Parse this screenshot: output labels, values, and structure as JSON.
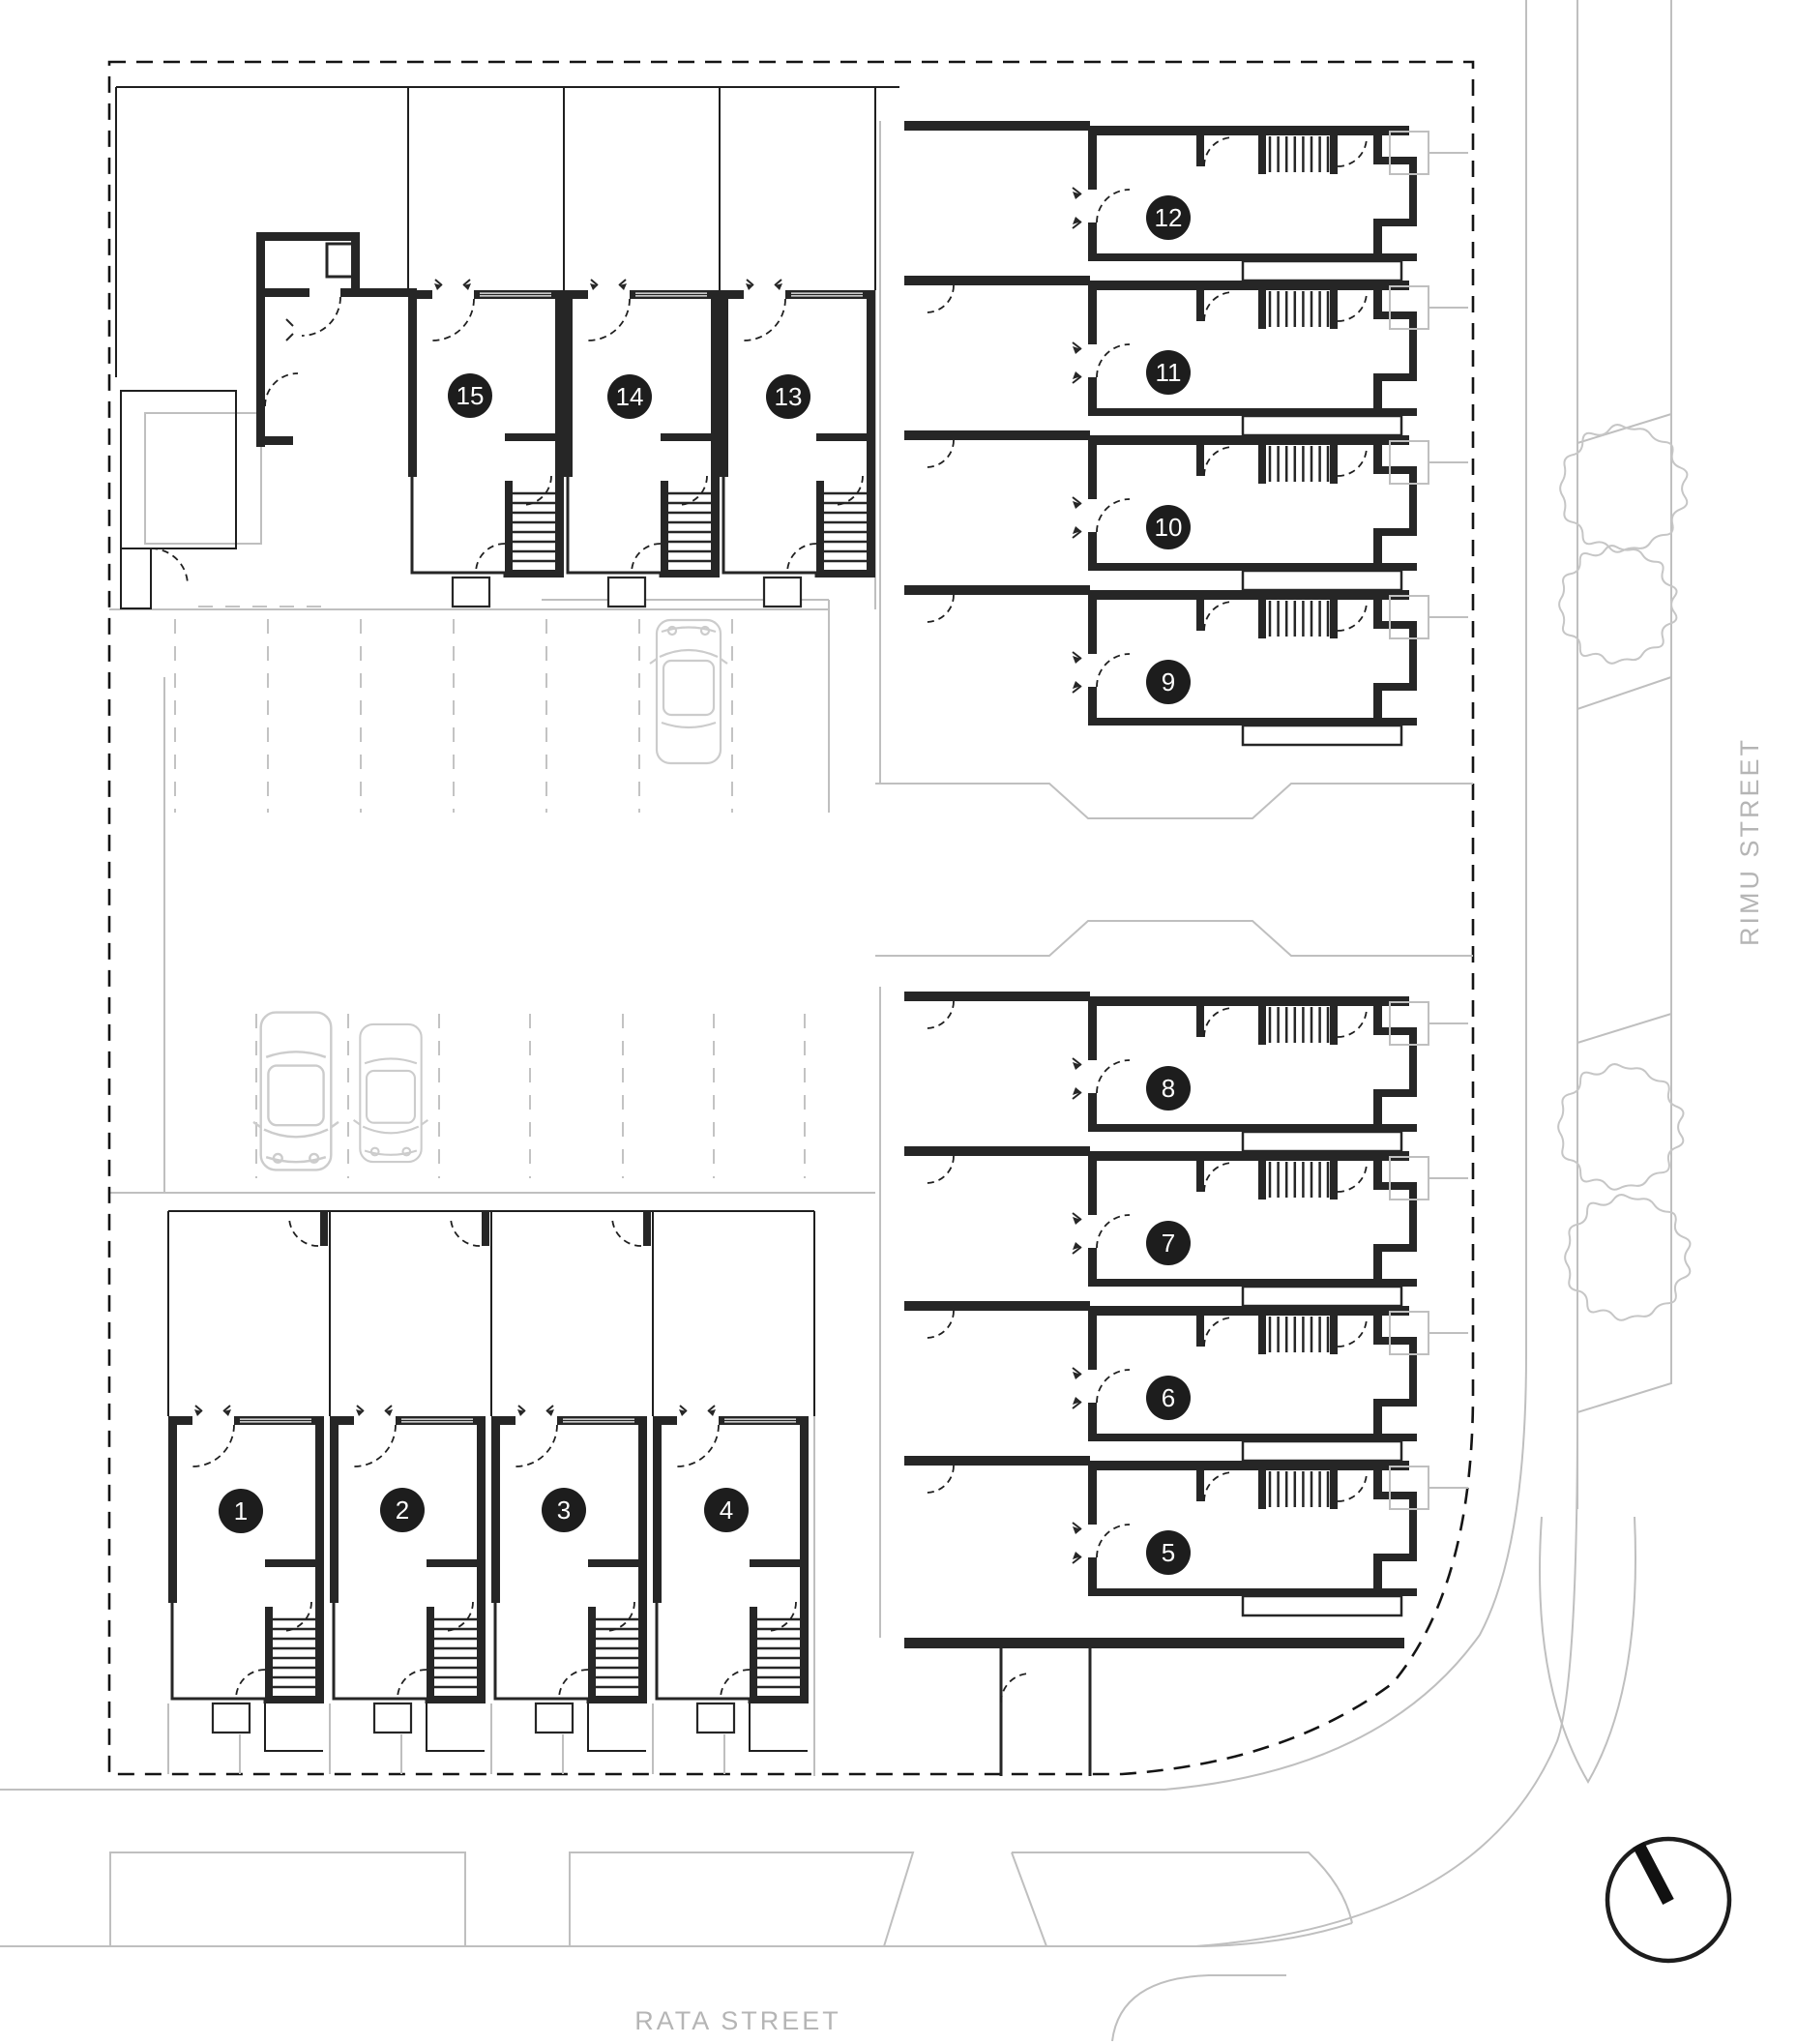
{
  "title": "Residential development site plan",
  "streets": {
    "bottom": "RATA STREET",
    "right": "RIMU STREET"
  },
  "units": [
    {
      "label": "1"
    },
    {
      "label": "2"
    },
    {
      "label": "3"
    },
    {
      "label": "4"
    },
    {
      "label": "5"
    },
    {
      "label": "6"
    },
    {
      "label": "7"
    },
    {
      "label": "8"
    },
    {
      "label": "9"
    },
    {
      "label": "10"
    },
    {
      "label": "11"
    },
    {
      "label": "12"
    },
    {
      "label": "13"
    },
    {
      "label": "14"
    },
    {
      "label": "15"
    }
  ],
  "icons": {
    "north_arrow": "north-arrow",
    "tree": "tree",
    "car": "car"
  },
  "colors": {
    "wall": "#262626",
    "site_line": "#1f1f1f",
    "street_gray": "#bfbfbf",
    "vehicle_gray": "#cccccc",
    "tree_gray": "#c6c6c6",
    "badge_fill": "#1d1d1d",
    "badge_text": "#ffffff",
    "street_text": "#b5b5b5"
  }
}
